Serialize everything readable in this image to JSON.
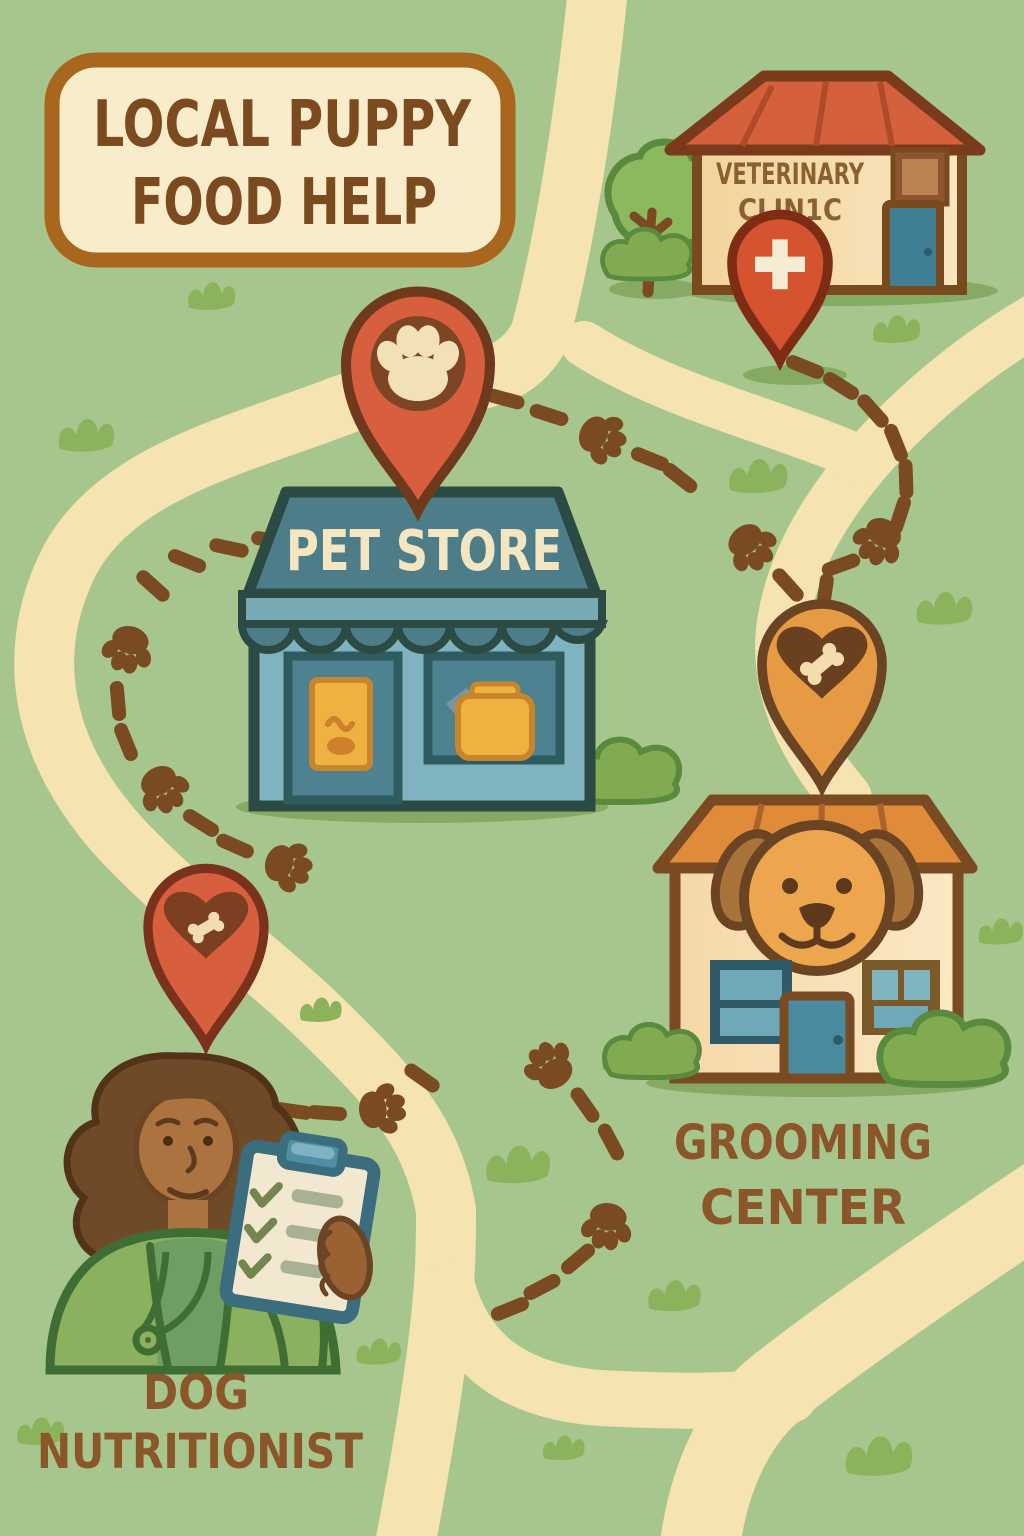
{
  "banner": {
    "line1": "LOCAL PUPPY",
    "line2": "FOOD HELP"
  },
  "locations": {
    "vet_clinic": {
      "sign_line1": "VETERINARY",
      "sign_line2": "CLIN1C",
      "pin_icon": "medical-cross-icon",
      "pin_color": "#d6532f"
    },
    "pet_store": {
      "sign": "PET STORE",
      "pin_icon": "paw-print-icon",
      "pin_color": "#d85f3d"
    },
    "grooming_center": {
      "label_line1": "GROOMING",
      "label_line2": "CENTER",
      "pin_icon": "heart-bone-icon",
      "pin_color": "#e59a43"
    },
    "dog_nutritionist": {
      "label_line1": "DOG",
      "label_line2": "NUTRITIONIST",
      "pin_icon": "heart-bone-icon",
      "pin_color": "#d85f3d"
    }
  },
  "colors": {
    "background": "#a7c68e",
    "road": "#f5e3b2",
    "trail": "#7a4a22",
    "banner_fill": "#f8ecca",
    "banner_border": "#a9661e",
    "title_text": "#7b4a1e",
    "label_text": "#8a562a",
    "vet_sign_text": "#8a6132",
    "store_sign_teal": "#4e7d8a",
    "store_body_blue": "#7fb3c0",
    "vet_roof_red": "#d4603c",
    "grooming_roof_orange": "#e08b3a",
    "building_cream": "#f6dcab"
  }
}
